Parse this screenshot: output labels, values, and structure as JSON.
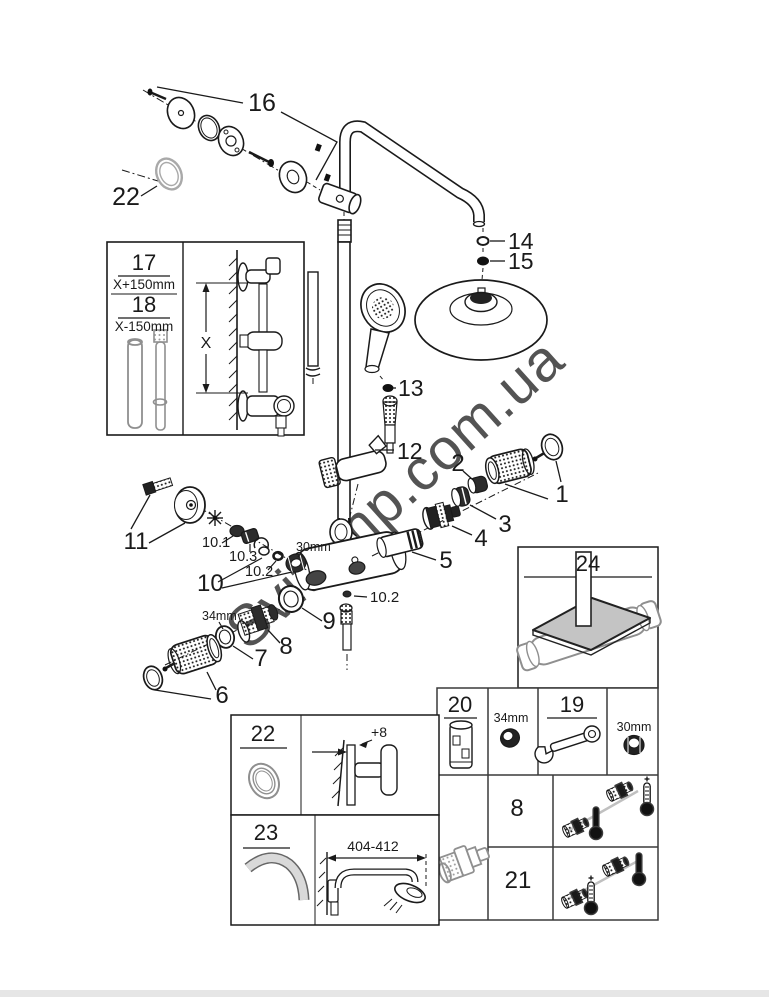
{
  "watermark": {
    "text": "Svitemp.com.ua"
  },
  "palette": {
    "line": "#1a1a1a",
    "gray_part": "#8f8f8f",
    "tray_fill": "#c4c4c4",
    "watermark_gray": "#cfcfcf",
    "footer_bar": "#e6e6e6",
    "connector_gray": "#c0c0c0"
  },
  "callouts": {
    "n16": "16",
    "n22": "22",
    "n14": "14",
    "n15": "15",
    "n13": "13",
    "n12": "12",
    "n1": "1",
    "n2": "2",
    "n3": "3",
    "n4": "4",
    "n5": "5",
    "n11": "11",
    "n10": "10",
    "n10_1": "10.1",
    "n10_3": "10.3",
    "n10_2": "10.2",
    "n10_2b": "10.2",
    "d30mm": "30mm",
    "d34mm": "34mm",
    "n9": "9",
    "n8": "8",
    "n7": "7",
    "n6": "6"
  },
  "inset_bar_lengths": {
    "n17": "17",
    "len17": "X+150mm",
    "n18": "18",
    "len18": "X-150mm",
    "axis": "X"
  },
  "inset_tray": {
    "n24": "24"
  },
  "inset_escutcheon": {
    "n22": "22",
    "offset": "+8"
  },
  "inset_arm": {
    "n23": "23",
    "range": "404-412"
  },
  "table": {
    "n20": "20",
    "d34": "34mm",
    "n19": "19",
    "d30": "30mm",
    "n8": "8",
    "n21": "21"
  }
}
